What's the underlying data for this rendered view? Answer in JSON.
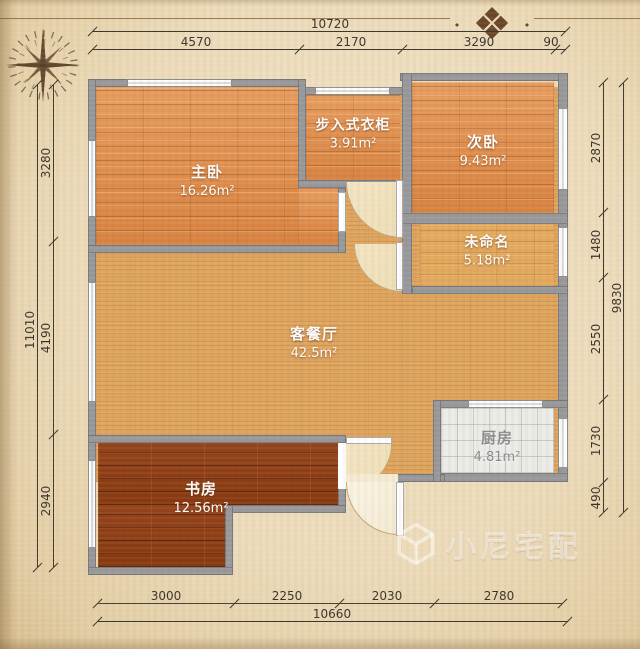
{
  "plan": {
    "rooms": [
      {
        "id": "master-bedroom",
        "name": "主卧",
        "area": "16.26m²"
      },
      {
        "id": "walk-in-closet",
        "name": "步入式衣柜",
        "area": "3.91m²"
      },
      {
        "id": "second-bedroom",
        "name": "次卧",
        "area": "9.43m²"
      },
      {
        "id": "unnamed-room",
        "name": "未命名",
        "area": "5.18m²"
      },
      {
        "id": "living-dining",
        "name": "客餐厅",
        "area": "42.5m²"
      },
      {
        "id": "kitchen",
        "name": "厨房",
        "area": "4.81m²"
      },
      {
        "id": "study",
        "name": "书房",
        "area": "12.56m²"
      }
    ],
    "dimensions": {
      "top": {
        "total": "10720",
        "segments": [
          "4570",
          "2170",
          "3290",
          "90"
        ]
      },
      "left": {
        "total": "11010",
        "segments": [
          "3280",
          "4190",
          "2940"
        ]
      },
      "right": {
        "total": "9830",
        "segments": [
          "2870",
          "1480",
          "2550",
          "1730",
          "490"
        ]
      },
      "bottom": {
        "total": "10660",
        "segments": [
          "3000",
          "2250",
          "2030",
          "2780"
        ]
      }
    }
  },
  "decorations": {
    "ornament_glyph": "❖",
    "ornament_dot": "•"
  },
  "watermark": {
    "text": "小尼宅配"
  },
  "colors": {
    "paper": "#ecdbba",
    "wall": "#98989b",
    "bedroom_floor": "#de8c4c",
    "living_floor": "#dfa55f",
    "study_floor": "#8e3e16",
    "kitchen_floor": "#ebebe7",
    "label_text": "#ffffff",
    "dimension_text": "#39332a"
  }
}
